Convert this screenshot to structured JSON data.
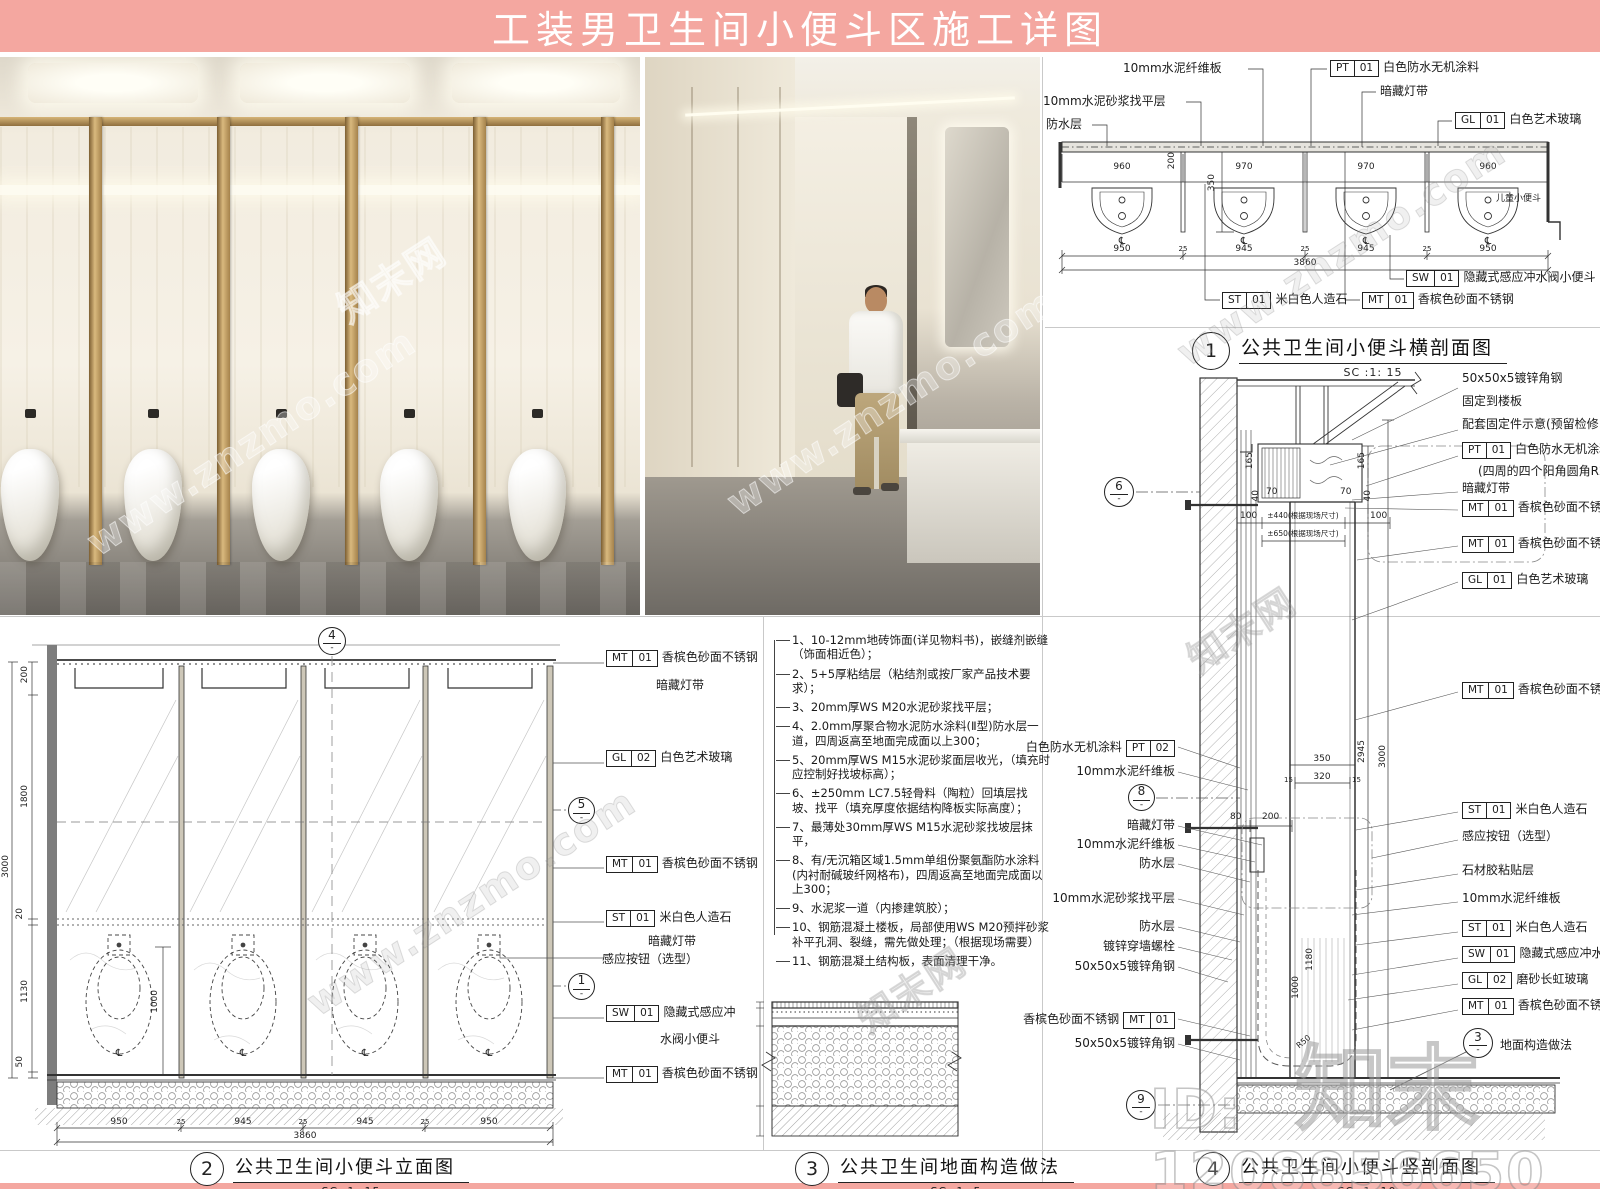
{
  "banner": {
    "title": "工装男卫生间小便斗区施工详图"
  },
  "misc": {
    "dash": "-",
    "cl": "℄"
  },
  "watermark": {
    "logo": "知末",
    "id_text": "ID: 1208856650",
    "url": "www.znzmo.com",
    "site": "知末网"
  },
  "captions": {
    "d1": {
      "num": "1",
      "title": "公共卫生间小便斗横剖面图",
      "scale": "SC :1:   15"
    },
    "d2": {
      "num": "2",
      "title": "公共卫生间小便斗立面图",
      "scale": "SC :1:   15"
    },
    "d3": {
      "num": "3",
      "title": "公共卫生间地面构造做法",
      "scale": "SC :1:   5"
    },
    "d4": {
      "num": "4",
      "title": "公共卫生间小便斗竖剖面图",
      "scale": "SC :1:   10"
    }
  },
  "plan": {
    "leader_labels": [
      "10mm水泥纤维板",
      "10mm水泥砂浆找平层",
      "防水层",
      "暗藏灯带",
      "儿童小便斗"
    ],
    "tags": [
      {
        "c": "PT",
        "n": "01",
        "t": "白色防水无机涂料"
      },
      {
        "c": "GL",
        "n": "01",
        "t": "白色艺术玻璃"
      },
      {
        "c": "ST",
        "n": "01",
        "t": "米白色人造石"
      },
      {
        "c": "MT",
        "n": "01",
        "t": "香槟色砂面不锈钢"
      },
      {
        "c": "SW",
        "n": "01",
        "t": "隐藏式感应冲水阀小便斗"
      }
    ],
    "dims": {
      "top": [
        "960",
        "970",
        "970",
        "960"
      ],
      "v200": "200",
      "v350": "350",
      "bot": [
        "950",
        "945",
        "945",
        "950"
      ],
      "sep": "25",
      "total": "3860"
    }
  },
  "elevation": {
    "bubbles": {
      "top": "4",
      "mid": "5",
      "low": "1"
    },
    "labels": [
      {
        "c": "MT",
        "n": "01",
        "t": "香槟色砂面不锈钢",
        "t2": "暗藏灯带"
      },
      {
        "c": "GL",
        "n": "02",
        "t": "白色艺术玻璃"
      },
      {
        "c": "MT",
        "n": "01",
        "t": "香槟色砂面不锈钢"
      },
      {
        "c": "ST",
        "n": "01",
        "t": "米白色人造石",
        "t2": "暗藏灯带"
      },
      {
        "t": "感应按钮（选型）"
      },
      {
        "c": "SW",
        "n": "01",
        "t": "隐藏式感应冲",
        "t2": "水阀小便斗"
      },
      {
        "c": "MT",
        "n": "01",
        "t": "香槟色砂面不锈钢"
      }
    ],
    "dims": {
      "left": [
        "200",
        "1800",
        "20",
        "1130",
        "50"
      ],
      "h": "3000",
      "inner": "1000",
      "bot": [
        "950",
        "945",
        "945",
        "950"
      ],
      "sep": "25",
      "total": "3860"
    }
  },
  "notes": {
    "items": [
      "1、10-12mm地砖饰面(详见物料书)，嵌缝剂嵌缝（饰面相近色）；",
      "2、5+5厚粘结层（粘结剂或按厂家产品技术要求）；",
      "3、20mm厚WS M20水泥砂浆找平层；",
      "4、2.0mm厚聚合物水泥防水涂料(Ⅱ型)防水层一道，四周返高至地面完成面以上300；",
      "5、20mm厚WS M15水泥砂浆面层收光，（填充时应控制好找坡标高）；",
      "6、±250mm LC7.5轻骨料（陶粒）回填层找坡、找平（填充厚度依据结构降板实际高度）；",
      "7、最薄处30mm厚WS M15水泥砂浆找坡层抹平，",
      "8、有/无沉箱区域1.5mm单组份聚氨酯防水涂料(内衬耐碱玻纤网格布)，四周返高至地面完成面以上300；",
      "9、水泥浆一道（内掺建筑胶）；",
      "10、钢筋混凝土楼板，局部使用WS M20预拌砂浆补平孔洞、裂缝，需先做处理；（根据现场需要）",
      "11、钢筋混凝土结构板，表面清理干净。"
    ]
  },
  "section": {
    "bubbles": {
      "b6": "6",
      "b8": "8",
      "b9": "9",
      "b3": "3"
    },
    "floor_ref": "地面构造做法",
    "left_labels": [
      {
        "t": "白色防水无机涂料",
        "c": "PT",
        "n": "02"
      },
      {
        "t": "10mm水泥纤维板"
      },
      {
        "t": "暗藏灯带"
      },
      {
        "t": "10mm水泥纤维板"
      },
      {
        "t": "防水层"
      },
      {
        "t": "10mm水泥砂浆找平层"
      },
      {
        "t": "防水层"
      },
      {
        "t": "镀锌穿墙螺栓"
      },
      {
        "t": "50x50x5镀锌角钢"
      },
      {
        "t": "香槟色砂面不锈钢",
        "c": "MT",
        "n": "01"
      },
      {
        "t": "50x50x5镀锌角钢"
      }
    ],
    "right_labels": [
      {
        "t": "50x50x5镀锌角钢",
        "t2": "固定到楼板"
      },
      {
        "t": "配套固定件示意(预留检修口)"
      },
      {
        "c": "PT",
        "n": "01",
        "t": "白色防水无机涂料",
        "t2": "(四周的四个阳角圆角R20)"
      },
      {
        "t": "暗藏灯带"
      },
      {
        "c": "MT",
        "n": "01",
        "t": "香槟色砂面不锈钢"
      },
      {
        "c": "MT",
        "n": "01",
        "t": "香槟色砂面不锈钢"
      },
      {
        "c": "GL",
        "n": "01",
        "t": "白色艺术玻璃"
      },
      {
        "c": "MT",
        "n": "01",
        "t": "香槟色砂面不锈钢"
      },
      {
        "c": "ST",
        "n": "01",
        "t": "米白色人造石"
      },
      {
        "t": "感应按钮（选型）"
      },
      {
        "t": "石材胶粘贴层"
      },
      {
        "t": "10mm水泥纤维板"
      },
      {
        "c": "ST",
        "n": "01",
        "t": "米白色人造石"
      },
      {
        "c": "SW",
        "n": "01",
        "t": "隐藏式感应冲水阀小便斗"
      },
      {
        "c": "GL",
        "n": "02",
        "t": "磨砂长虹玻璃"
      },
      {
        "c": "MT",
        "n": "01",
        "t": "香槟色砂面不锈钢"
      }
    ],
    "dims": {
      "d165a": "165",
      "d70a": "70",
      "d40a": "40",
      "d165b": "165",
      "d70b": "70",
      "d40b": "40",
      "d100a": "100",
      "pm440": "±440(根据现场尺寸)",
      "d100b": "100",
      "pm650": "±650(根据现场尺寸)",
      "d350": "350",
      "d320": "320",
      "d15a": "15",
      "d15b": "15",
      "d2945": "2945",
      "d3000": "3000",
      "d80": "80",
      "d200": "200",
      "d1180": "1180",
      "d1000": "1000",
      "r50": "R50"
    }
  }
}
